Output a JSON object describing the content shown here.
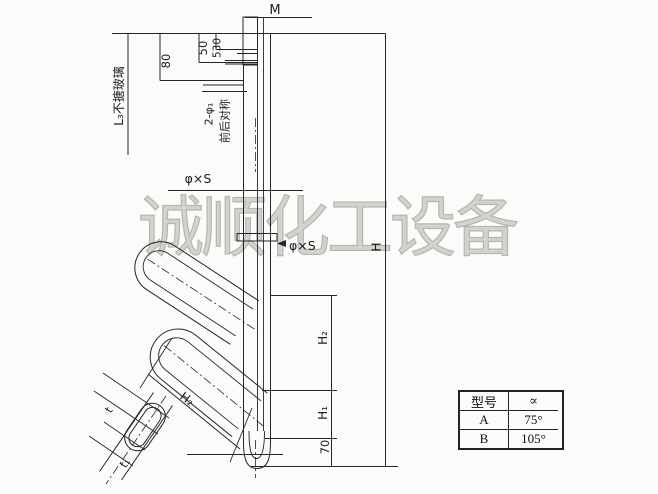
{
  "watermark": {
    "text": "诚顺化工设备"
  },
  "labels": {
    "m": "M",
    "dim_80": "80",
    "dim_50": "50",
    "dim_530": "530",
    "glass_note": "L₃不搪玻璃",
    "holes": "2-φ₁",
    "symmetry": "前后对称",
    "phi_s_upper": "φ×S",
    "phi_s_flange": "φ×S",
    "h_total": "H",
    "h2_right": "H₂",
    "h1_right": "H₁",
    "dim_70": "70",
    "h2_branch": "H₂",
    "dim_t": "t",
    "dim_t1": "t₁"
  },
  "table": {
    "headers": [
      "型号",
      "∝"
    ],
    "rows": [
      [
        "A",
        "75°"
      ],
      [
        "B",
        "105°"
      ]
    ]
  }
}
